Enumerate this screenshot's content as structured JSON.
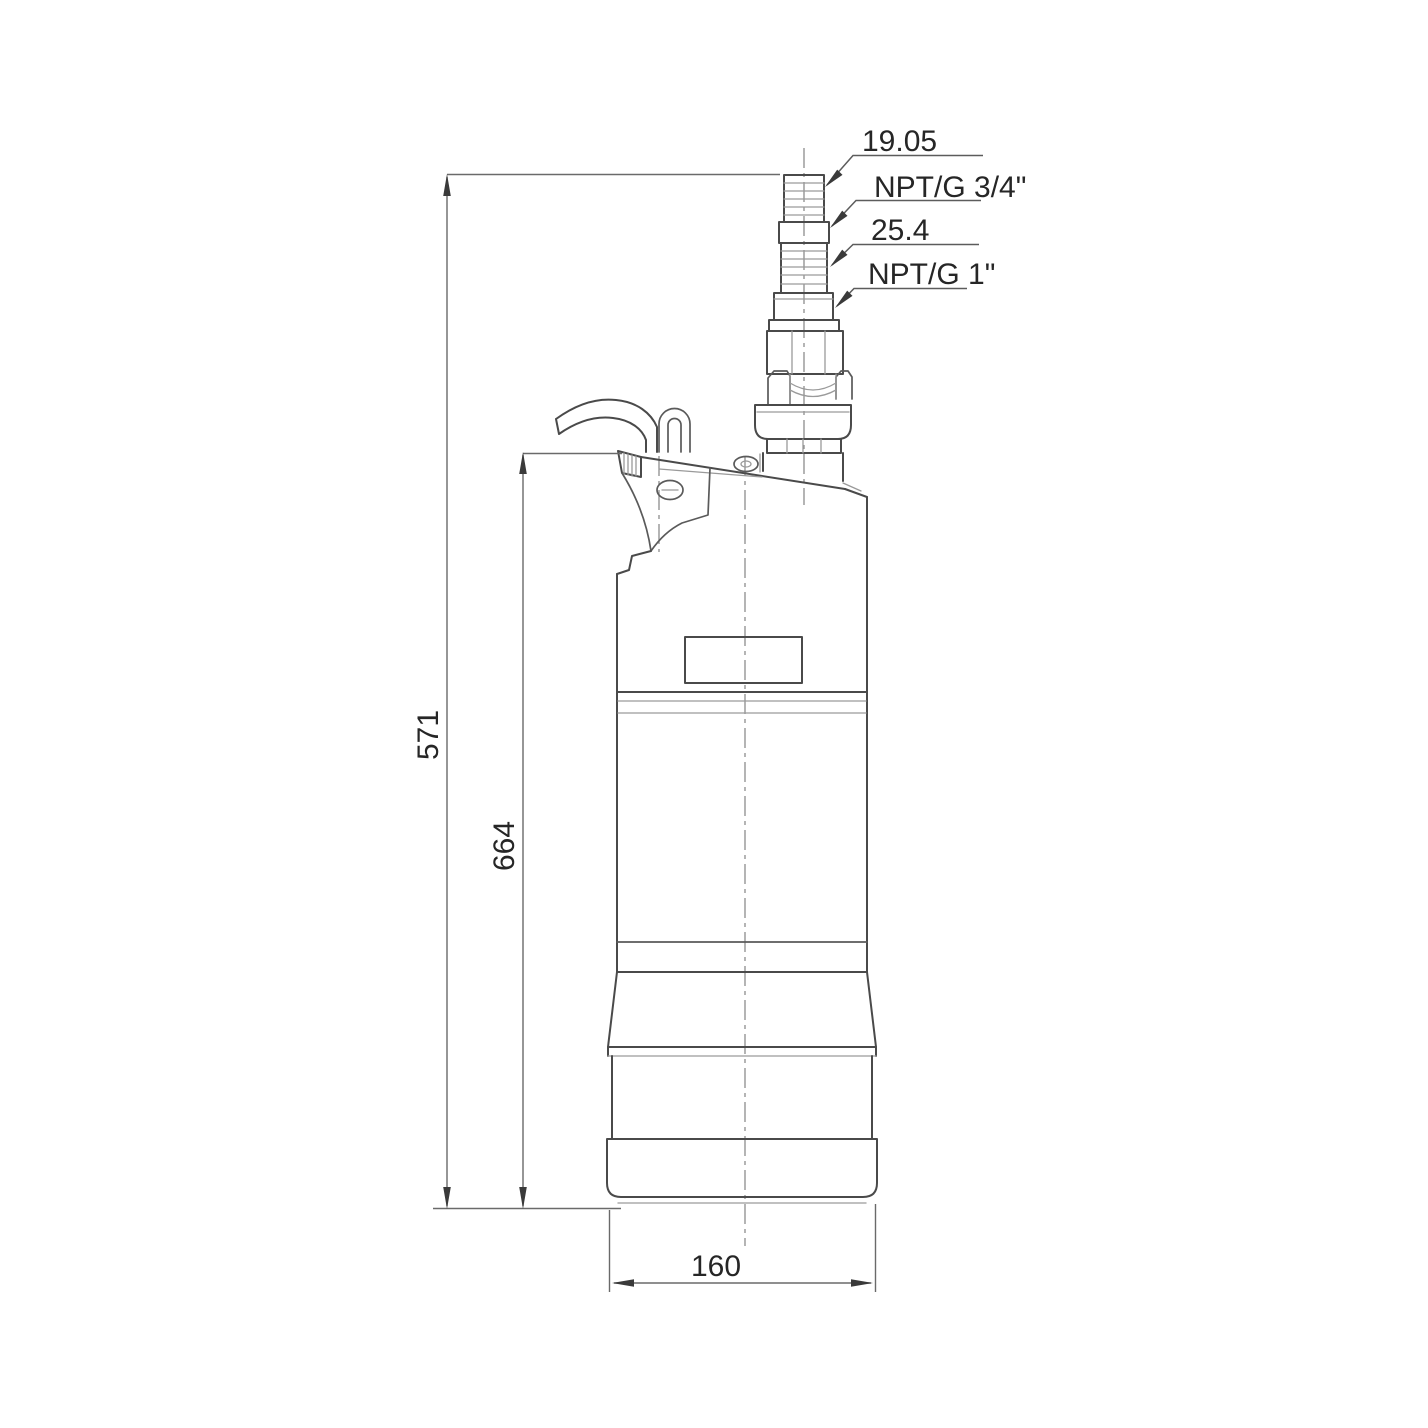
{
  "page": {
    "background": "#ffffff",
    "line_color": "#4a4a4a",
    "text_color": "#262626"
  },
  "drawing": {
    "callouts": [
      {
        "label": "19.05"
      },
      {
        "label": "NPT/G 3/4\""
      },
      {
        "label": "25.4"
      },
      {
        "label": "NPT/G 1\""
      }
    ],
    "dimensions": {
      "left_outer_height": "571",
      "left_inner_height": "664",
      "bottom_width": "160"
    }
  }
}
